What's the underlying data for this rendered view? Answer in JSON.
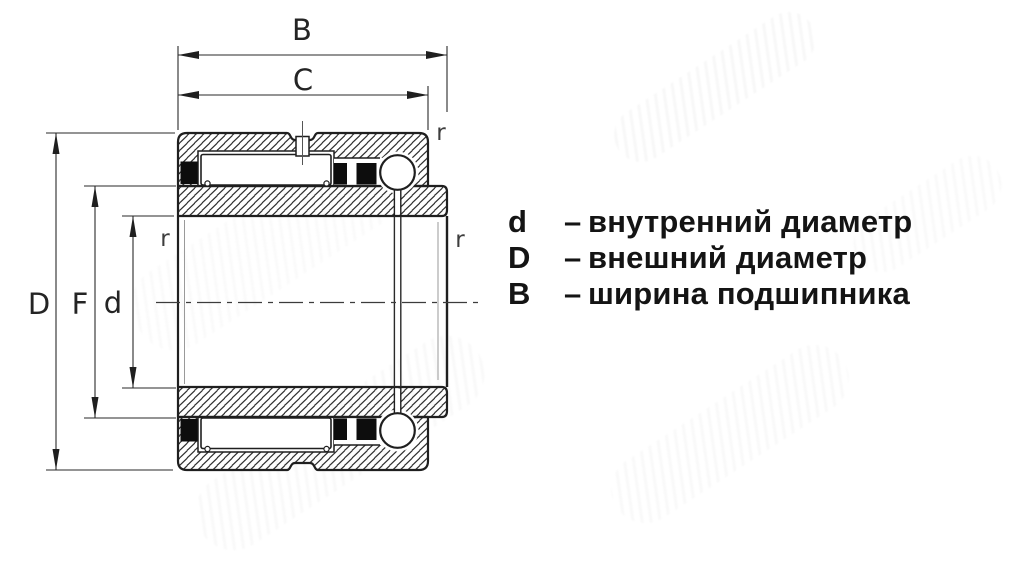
{
  "drawing": {
    "title": "bearing-cross-section",
    "line_color": "#1f1f1f",
    "hatch_color": "#2e2e2e",
    "centerline_color": "#3c3c3c"
  },
  "dims": {
    "width_total": "B",
    "width_outer": "C",
    "outer_diameter": "D",
    "inner_race_diameter": "F",
    "bore_diameter": "d",
    "fillet_radius": "r"
  },
  "legend": {
    "items": [
      {
        "key": "d",
        "dash": "–",
        "text": "внутренний диаметр"
      },
      {
        "key": "D",
        "dash": "–",
        "text": "внешний диаметр"
      },
      {
        "key": "B",
        "dash": "–",
        "text": "ширина подшипника"
      }
    ]
  }
}
